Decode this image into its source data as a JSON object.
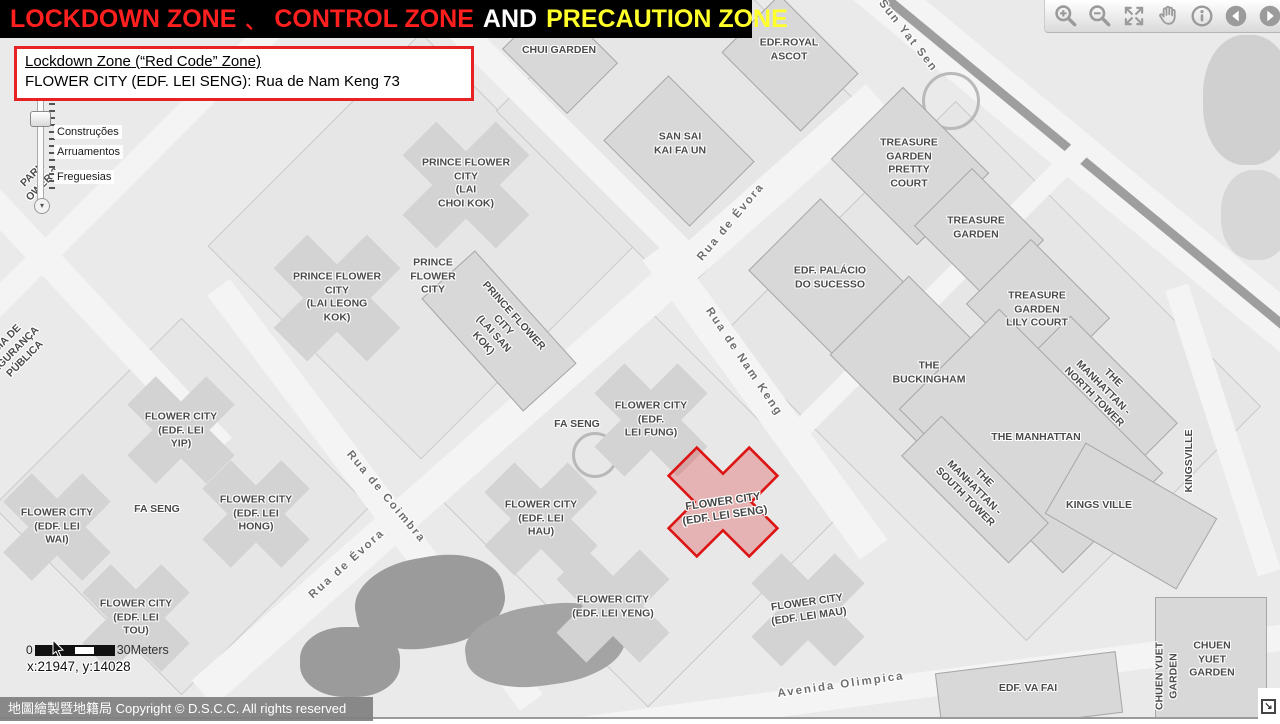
{
  "title": {
    "lockdown": "LOCKDOWN ZONE",
    "separator": "、",
    "control": "CONTROL ZONE",
    "and": "AND",
    "precaution": "PRECAUTION ZONE"
  },
  "info_box": {
    "line1": "Lockdown Zone (“Red Code” Zone)",
    "line2": "FLOWER CITY (EDF. LEI SENG): Rua de Nam Keng 73"
  },
  "toolbar": {
    "tools": [
      "zoom-in",
      "zoom-out",
      "full-extent",
      "pan",
      "identify",
      "previous-extent",
      "next-extent"
    ]
  },
  "zoom_slider": {
    "levels": [
      {
        "label": "Construções",
        "y": 132
      },
      {
        "label": "Arruamentos",
        "y": 152
      },
      {
        "label": "Freguesias",
        "y": 177
      }
    ],
    "down_arrow": "▾"
  },
  "scale_bar": {
    "start": "0",
    "end": "30Meters"
  },
  "coordinates": "x:21947, y:14028",
  "copyright": "地圖繪製暨地籍局 Copyright © D.S.C.C. All rights reserved",
  "resize_corner": "↘",
  "colors": {
    "title_red": "#ff1f1f",
    "title_yellow": "#ffff29",
    "info_border": "#e62222",
    "highlight_stroke": "#dd1414",
    "highlight_fill": "rgba(221,20,20,0.25)"
  },
  "highlight": {
    "label": "FLOWER CITY\n(EDF. LEI SENG)",
    "x": 724,
    "y": 509,
    "rot": -8
  },
  "map": {
    "building_labels": [
      {
        "name": "chui-garden",
        "text": "CHUI GARDEN",
        "x": 559,
        "y": 51,
        "rot": 0
      },
      {
        "name": "edf-royal-ascot",
        "text": "EDF.ROYAL\nASCOT",
        "x": 789,
        "y": 50,
        "rot": 0
      },
      {
        "name": "san-sai-kai-fa-un",
        "text": "SAN SAI\nKAI FA UN",
        "x": 680,
        "y": 144,
        "rot": 0
      },
      {
        "name": "treasure-garden-pretty-court",
        "text": "TREASURE\nGARDEN\nPRETTY\nCOURT",
        "x": 909,
        "y": 164,
        "rot": 0
      },
      {
        "name": "treasure-garden",
        "text": "TREASURE\nGARDEN",
        "x": 976,
        "y": 228,
        "rot": 0
      },
      {
        "name": "edf-palacio-do-sucesso",
        "text": "EDF. PALÁCIO\nDO SUCESSO",
        "x": 830,
        "y": 278,
        "rot": 0
      },
      {
        "name": "treasure-garden-lily-court",
        "text": "TREASURE\nGARDEN\nLILY COURT",
        "x": 1037,
        "y": 310,
        "rot": 0
      },
      {
        "name": "the-buckingham",
        "text": "THE\nBUCKINGHAM",
        "x": 929,
        "y": 373,
        "rot": 0
      },
      {
        "name": "the-manhattan-north-tower",
        "text": "THE\nMANHATTAN -\nNORTH TOWER",
        "x": 1103,
        "y": 388,
        "rot": 45
      },
      {
        "name": "the-manhattan",
        "text": "THE MANHATTAN",
        "x": 1036,
        "y": 438,
        "rot": 0
      },
      {
        "name": "the-manhattan-south-tower",
        "text": "THE\nMANHATTAN -\nSOUTH TOWER",
        "x": 974,
        "y": 488,
        "rot": 45
      },
      {
        "name": "kings-ville",
        "text": "KINGS VILLE",
        "x": 1099,
        "y": 506,
        "rot": 0
      },
      {
        "name": "kingsville-vertical",
        "text": "KINGSVILLE",
        "x": 1190,
        "y": 461,
        "rot": -90
      },
      {
        "name": "prince-flower-city-lai-choi-kok",
        "text": "PRINCE FLOWER\nCITY\n(LAI\nCHOI KOK)",
        "x": 466,
        "y": 184,
        "rot": 0
      },
      {
        "name": "prince-flower-city",
        "text": "PRINCE\nFLOWER\nCITY",
        "x": 433,
        "y": 277,
        "rot": 0
      },
      {
        "name": "prince-flower-city-lai-leong-kok",
        "text": "PRINCE FLOWER\nCITY\n(LAI LEONG\nKOK)",
        "x": 337,
        "y": 298,
        "rot": 0
      },
      {
        "name": "prince-flower-city-lai-san-kok",
        "text": "PRINCE FLOWER\nCITY\n(LAI SAN\nKOK)",
        "x": 498,
        "y": 330,
        "rot": 48
      },
      {
        "name": "flower-city-edf-lei-yip",
        "text": "FLOWER CITY\n(EDF. LEI\nYIP)",
        "x": 181,
        "y": 431,
        "rot": 0
      },
      {
        "name": "flower-city-edf-lei-wai",
        "text": "FLOWER CITY\n(EDF. LEI\nWAI)",
        "x": 57,
        "y": 527,
        "rot": 0
      },
      {
        "name": "fa-seng-west",
        "text": "FA SENG",
        "x": 157,
        "y": 510,
        "rot": 0
      },
      {
        "name": "flower-city-edf-lei-hong",
        "text": "FLOWER CITY\n(EDF. LEI\nHONG)",
        "x": 256,
        "y": 514,
        "rot": 0
      },
      {
        "name": "flower-city-edf-lei-tou",
        "text": "FLOWER CITY\n(EDF. LEI\nTOU)",
        "x": 136,
        "y": 618,
        "rot": 0
      },
      {
        "name": "fa-seng-central",
        "text": "FA SENG",
        "x": 577,
        "y": 425,
        "rot": 0
      },
      {
        "name": "flower-city-edf-lei-fung",
        "text": "FLOWER CITY\n(EDF.\nLEI FUNG)",
        "x": 651,
        "y": 420,
        "rot": 0
      },
      {
        "name": "flower-city-edf-lei-hau",
        "text": "FLOWER CITY\n(EDF. LEI\nHAU)",
        "x": 541,
        "y": 519,
        "rot": 0
      },
      {
        "name": "flower-city-edf-lei-yeng",
        "text": "FLOWER CITY\n(EDF. LEI YENG)",
        "x": 613,
        "y": 607,
        "rot": 0
      },
      {
        "name": "flower-city-edf-lei-mau",
        "text": "FLOWER CITY\n(EDF. LEI MAU)",
        "x": 808,
        "y": 610,
        "rot": -8
      },
      {
        "name": "edf-va-fai",
        "text": "EDF. VA FAI",
        "x": 1028,
        "y": 689,
        "rot": 0
      },
      {
        "name": "chuen-yuet-garden-vertical",
        "text": "CHUEN YUET\nGARDEN",
        "x": 1167,
        "y": 676,
        "rot": -90
      },
      {
        "name": "chuen-yuet-garden",
        "text": "CHUEN\nYUET\nGARDEN",
        "x": 1212,
        "y": 660,
        "rot": 0
      },
      {
        "name": "park-tower-3",
        "text": "PARK\nOWER 3",
        "x": 38,
        "y": 180,
        "rot": -45
      },
      {
        "name": "policia-seguranca-publica",
        "text": "ÍCIA DE\nEGURANÇA\nPÚBLICA",
        "x": 16,
        "y": 350,
        "rot": -45
      }
    ],
    "street_labels": [
      {
        "name": "sun-yat-sen",
        "text": "Sun Yat Sen",
        "x": 908,
        "y": 36,
        "rot": 52
      },
      {
        "name": "rua-de-evora-north",
        "text": "Rua de Évora",
        "x": 731,
        "y": 222,
        "rot": -50
      },
      {
        "name": "rua-de-nam-keng",
        "text": "Rua de Nam Keng",
        "x": 744,
        "y": 362,
        "rot": 56
      },
      {
        "name": "rua-de-coimbra",
        "text": "Rua de Coimbra",
        "x": 386,
        "y": 497,
        "rot": 50
      },
      {
        "name": "rua-de-evora-south",
        "text": "Rua de Évora",
        "x": 347,
        "y": 564,
        "rot": -42
      },
      {
        "name": "avenida-olimpica",
        "text": "Avenida Olimpica",
        "x": 841,
        "y": 685,
        "rot": -8
      }
    ]
  }
}
